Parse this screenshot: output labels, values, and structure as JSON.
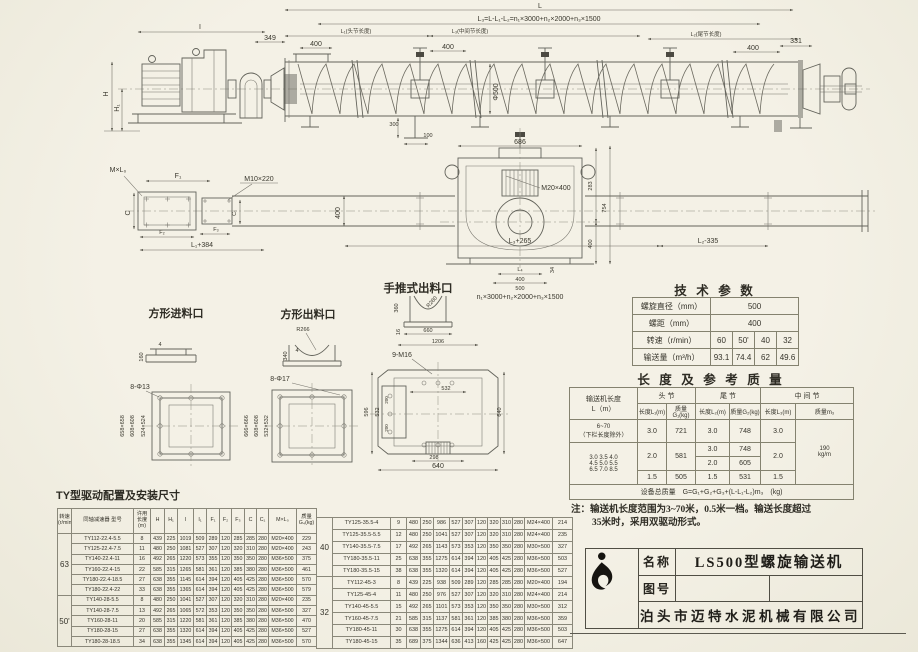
{
  "colors": {
    "paper": "#f2efe2",
    "line": "#63635b",
    "text": "#38362c",
    "table_border": "#84826f",
    "logo": "#161410"
  },
  "captions": {
    "square_inlet": "方形进料口",
    "square_outlet": "方形出料口",
    "push_outlet": "手推式出料口",
    "drive_config": "TY型驱动配置及安装尺寸"
  },
  "side_view": {
    "l": "L",
    "l3_formula": "L₃=L-L₁-L₂=n₁×3000+n₂×2000+n₃×1500",
    "i": "I",
    "d349": "349",
    "l1": "L₁(头节长度)",
    "d400_head": "400",
    "l3": "L₃(中间节长度)",
    "d400_mid": "400",
    "phi500": "Φ500",
    "l2": "L₂(尾节长度)",
    "d400_tail": "400",
    "d331": "331",
    "h": "H",
    "h1": "H₁",
    "d300": "300",
    "d100": "100"
  },
  "plan_view": {
    "mxl0": "M×L₀",
    "f1": "F₁",
    "m10x220": "M10×220",
    "c": "C",
    "c1": "C₁",
    "f2": "F₂",
    "f3": "F₃",
    "l1_384": "L₁+384",
    "d400": "400",
    "l3_265": "L₃+265",
    "l2_335": "L₂-335"
  },
  "section_view": {
    "d686": "686",
    "m20x400": "M20×400",
    "d283": "283",
    "d754": "754",
    "d400": "400",
    "l4": "L₄",
    "d400b": "400",
    "d500": "500",
    "d34": "34",
    "formula": "n₁×3000+n₂×2000+n₃×1500"
  },
  "square_inlet": {
    "d4": "4",
    "d160": "160",
    "holes": "8-Φ13",
    "outer": "658×658",
    "mid": "608×608",
    "inner": "524×524"
  },
  "square_outlet": {
    "r266": "R266",
    "d4": "4",
    "d340": "340",
    "holes": "8-Φ17",
    "outer": "666×666",
    "mid": "608×608",
    "inner": "532×532"
  },
  "push_outlet": {
    "r260": "R260",
    "d360": "360",
    "d16": "16",
    "d660": "660",
    "d1206": "1206",
    "holes": "9-M16",
    "d532_h": "532",
    "d596": "596",
    "d532_v": "532",
    "d200a": "200",
    "d200b": "200",
    "d640_r": "640",
    "d298": "298",
    "d640_b": "640"
  },
  "tech_params": {
    "title": "技 术 参 数",
    "rows": [
      {
        "label": "螺旋直径（mm）",
        "values": [
          "500"
        ]
      },
      {
        "label": "螺距（mm）",
        "values": [
          "400"
        ]
      },
      {
        "label": "转速（r/min）",
        "values": [
          "60",
          "50'",
          "40",
          "32"
        ]
      },
      {
        "label": "输送量（m³/h）",
        "values": [
          "93.1",
          "74.4",
          "62",
          "49.6"
        ]
      }
    ]
  },
  "length_mass": {
    "title": "长 度 及 参 考 质 量",
    "headers": {
      "length_col": "输送机长度",
      "length_col2": "L（m）",
      "head": "头 节",
      "tail": "尾 节",
      "middle": "中 间 节",
      "len1": "长度L₁(m)",
      "mass1": "质量G₁(kg)",
      "len2": "长度L₂(m)",
      "mass2": "质量G₂(kg)",
      "len3": "长度L₃(m)",
      "mass3": "质量m₃"
    },
    "row_main": {
      "range1": "6~70",
      "range2": "（下栏长度除外）",
      "l1": "3.0",
      "g1": "721",
      "l2": "3.0",
      "g2": "748",
      "l3": "3.0"
    },
    "row_short": {
      "r1": "3.0 3.5 4.0",
      "r2": "4.5 5.0 5.5",
      "r3": "6.5 7.0 8.5",
      "l1a": "2.0",
      "g1a": "581",
      "l2a": "3.0",
      "g2a": "748",
      "l2b": "2.0",
      "g2b": "605",
      "l3a": "2.0",
      "l1b": "1.5",
      "g1b": "505",
      "l2c": "1.5",
      "g2c": "531",
      "l3b": "1.5"
    },
    "m3a": "190",
    "m3b": "kg/m",
    "footer": "设备总质量　G=G₁+G₂+G₃+(L-L₁-L₂)m₃　(kg)"
  },
  "note": {
    "line1": "注：输送机长度范围为3~70米，0.5米一档。输送长度超过",
    "line2": "35米时，采用双驱动形式。"
  },
  "mount_table": {
    "headers": [
      "转速 (r/min)",
      "同轴减速器 型号",
      "许用 长度 (m)",
      "H",
      "H₁",
      "I",
      "I₁",
      "F₁",
      "F₂",
      "F₃",
      "C",
      "C₁",
      "M×L₀",
      "质量 G₄(kg)"
    ],
    "left_groups": [
      {
        "speed": "63",
        "rows": [
          [
            "TY112-22.4-5.5",
            "8",
            "439",
            "225",
            "1019",
            "509",
            "289",
            "120",
            "285",
            "285",
            "280",
            "M20×400",
            "229"
          ],
          [
            "TY125-22.4-7.5",
            "11",
            "480",
            "250",
            "1081",
            "527",
            "307",
            "120",
            "320",
            "310",
            "280",
            "M20×400",
            "243"
          ],
          [
            "TY140-22.4-11",
            "16",
            "492",
            "265",
            "1220",
            "573",
            "355",
            "120",
            "350",
            "350",
            "280",
            "M36×500",
            "375"
          ],
          [
            "TY160-22.4-15",
            "22",
            "585",
            "315",
            "1265",
            "581",
            "361",
            "120",
            "385",
            "380",
            "280",
            "M36×500",
            "461"
          ],
          [
            "TY180-22.4-18.5",
            "27",
            "638",
            "355",
            "1145",
            "614",
            "394",
            "120",
            "405",
            "425",
            "280",
            "M36×500",
            "570"
          ],
          [
            "TY180-22.4-22",
            "33",
            "638",
            "355",
            "1365",
            "614",
            "394",
            "120",
            "405",
            "425",
            "280",
            "M36×500",
            "579"
          ]
        ]
      },
      {
        "speed": "50'",
        "rows": [
          [
            "TY140-28-5.5",
            "8",
            "480",
            "250",
            "1041",
            "527",
            "307",
            "120",
            "320",
            "310",
            "280",
            "M20×400",
            "235"
          ],
          [
            "TY140-28-7.5",
            "13",
            "492",
            "265",
            "1065",
            "572",
            "353",
            "120",
            "350",
            "350",
            "280",
            "M36×500",
            "327"
          ],
          [
            "TY160-28-11",
            "20",
            "585",
            "315",
            "1220",
            "581",
            "361",
            "120",
            "385",
            "380",
            "280",
            "M36×500",
            "470"
          ],
          [
            "TY180-28-15",
            "27",
            "638",
            "355",
            "1320",
            "614",
            "394",
            "120",
            "405",
            "425",
            "280",
            "M36×500",
            "527"
          ],
          [
            "TY180-28-18.5",
            "34",
            "638",
            "355",
            "1345",
            "614",
            "394",
            "120",
            "405",
            "425",
            "280",
            "M36×500",
            "570"
          ]
        ]
      }
    ],
    "right_groups": [
      {
        "speed": "40",
        "rows": [
          [
            "TY125-35.5-4",
            "9",
            "480",
            "250",
            "986",
            "527",
            "307",
            "120",
            "320",
            "310",
            "280",
            "M24×400",
            "214"
          ],
          [
            "TY125-35.5-5.5",
            "12",
            "480",
            "250",
            "1041",
            "527",
            "307",
            "120",
            "320",
            "310",
            "280",
            "M24×400",
            "235"
          ],
          [
            "TY140-35.5-7.5",
            "17",
            "492",
            "265",
            "1143",
            "573",
            "353",
            "120",
            "350",
            "350",
            "280",
            "M30×500",
            "327"
          ],
          [
            "TY180-35.5-11",
            "25",
            "638",
            "355",
            "1275",
            "614",
            "394",
            "120",
            "405",
            "425",
            "280",
            "M36×500",
            "503"
          ],
          [
            "TY180-35.5-15",
            "38",
            "638",
            "355",
            "1320",
            "614",
            "394",
            "120",
            "405",
            "425",
            "280",
            "M36×500",
            "527"
          ]
        ]
      },
      {
        "speed": "32",
        "rows": [
          [
            "TY112-45-3",
            "8",
            "439",
            "225",
            "938",
            "509",
            "289",
            "120",
            "285",
            "285",
            "280",
            "M20×400",
            "194"
          ],
          [
            "TY125-45-4",
            "11",
            "480",
            "250",
            "976",
            "527",
            "307",
            "120",
            "320",
            "310",
            "280",
            "M24×400",
            "214"
          ],
          [
            "TY140-45-5.5",
            "15",
            "492",
            "265",
            "1101",
            "573",
            "353",
            "120",
            "350",
            "350",
            "280",
            "M30×500",
            "312"
          ],
          [
            "TY160-45-7.5",
            "21",
            "585",
            "315",
            "1137",
            "581",
            "361",
            "120",
            "385",
            "380",
            "280",
            "M36×500",
            "359"
          ],
          [
            "TY180-45-11",
            "30",
            "638",
            "355",
            "1275",
            "614",
            "394",
            "120",
            "405",
            "425",
            "280",
            "M36×500",
            "503"
          ],
          [
            "TY180-45-15",
            "35",
            "689",
            "375",
            "1344",
            "636",
            "413",
            "160",
            "425",
            "425",
            "280",
            "M36×500",
            "647"
          ]
        ]
      }
    ]
  },
  "title_block": {
    "name_label": "名称",
    "name_value": "LS500型螺旋输送机",
    "drawing_no_label": "图号",
    "drawing_no_value": "",
    "company": "泊头市迈特水泥机械有限公司"
  }
}
